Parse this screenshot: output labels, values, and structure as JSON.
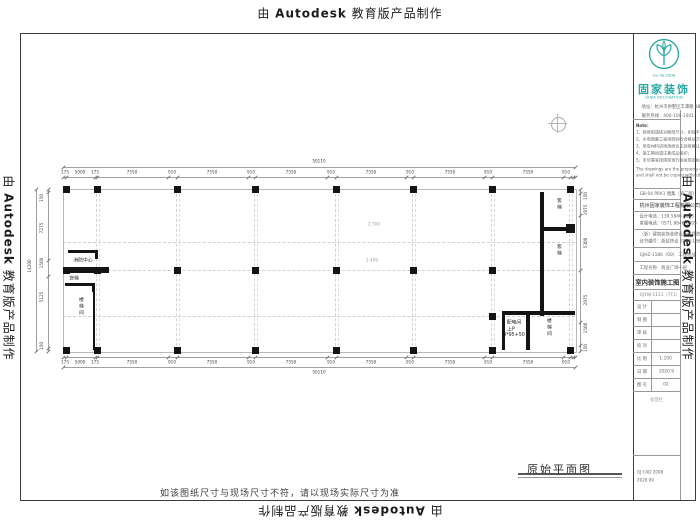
{
  "watermark": {
    "prefix": "由 ",
    "brand": "Autodesk",
    "suffix": " 教育版产品制作"
  },
  "footer_note": "如该图纸尺寸与现场尺寸不符，请以现场实际尺寸为准",
  "drawing_title": "原始平面图",
  "brand": {
    "color": "#2aa7a2",
    "badge_year": "Gu Jia 2008",
    "name_cn": "固家装饰",
    "name_en": "GUJIA DECORATION"
  },
  "titleblock": {
    "address_lines": [
      "地址：杭州市拱墅区丰潭路 88 号",
      "服务热线：400-100-1001"
    ],
    "note_title": "Note：",
    "notes": [
      "1、装修前请核对图纸尺寸，如有不符请及时联系设计师；",
      "2、水电隐蔽工程须经验收合格后方可封闭；",
      "3、所有材料进场须经业主验收确认后方可施工；",
      "4、施工期间请注意成品保护；",
      "5、未尽事宜按国家现行相关规范执行。"
    ],
    "legal_lines": [
      "The drawings are the property of GUJIA DECORATION",
      "and shall not be copied without permission."
    ],
    "spec_line": "GB-04 PRA1 图集（第二版）",
    "company": "杭州固家装饰工程有限公司",
    "phone_lines": [
      "设计电话：139 5846 6805",
      "客服电话：0571 8846 6805"
    ],
    "cert_lines": [
      "（浙）建筑装饰装修设计专项资质",
      "证书编号：浙装饰设 2008-186 号"
    ],
    "project_no_line": "GJHZ-1186（00） 工程地址",
    "project_name_line": "工程名称：商业广场一层",
    "doc_type": "室内装饰施工图",
    "doc_code": "GJYW-1111（7F1）",
    "table_rows": [
      [
        "设 计",
        ""
      ],
      [
        "制 图",
        ""
      ],
      [
        "审 核",
        ""
      ],
      [
        "校 对",
        ""
      ],
      [
        "比 例",
        "1:100"
      ],
      [
        "日 期",
        "2020.9"
      ],
      [
        "图 号",
        "02"
      ]
    ],
    "visa_label": "会签栏",
    "footer_lines": [
      "GJ·CAD 2008",
      "2020.09"
    ]
  },
  "plan": {
    "outline": [
      63,
      189,
      512,
      162
    ],
    "dash_v": [
      97,
      177,
      255,
      336,
      413,
      492,
      570
    ],
    "dash_h": [
      242,
      270,
      316
    ],
    "columns": [
      [
        66,
        189
      ],
      [
        97,
        189
      ],
      [
        177,
        189
      ],
      [
        255,
        189
      ],
      [
        336,
        189
      ],
      [
        413,
        189
      ],
      [
        492,
        189
      ],
      [
        570,
        189
      ],
      [
        66,
        270
      ],
      [
        97,
        270
      ],
      [
        177,
        270
      ],
      [
        255,
        270
      ],
      [
        336,
        270
      ],
      [
        413,
        270
      ],
      [
        492,
        270
      ],
      [
        66,
        350
      ],
      [
        97,
        350
      ],
      [
        177,
        350
      ],
      [
        255,
        350
      ],
      [
        336,
        350
      ],
      [
        413,
        350
      ],
      [
        492,
        350
      ],
      [
        570,
        350
      ],
      [
        492,
        316
      ]
    ],
    "walls": [
      [
        68,
        250,
        30,
        3
      ],
      [
        95,
        250,
        3,
        9
      ],
      [
        63,
        267,
        46,
        6
      ],
      [
        65,
        283,
        30,
        3
      ],
      [
        92,
        283,
        3,
        9
      ],
      [
        93,
        286,
        2,
        64
      ],
      [
        540,
        192,
        4,
        124
      ],
      [
        544,
        227,
        28,
        4
      ],
      [
        566,
        224,
        9,
        9
      ],
      [
        502,
        311,
        73,
        4
      ],
      [
        502,
        315,
        3,
        35
      ],
      [
        526,
        315,
        4,
        35
      ]
    ],
    "dim_lines": [
      [
        63,
        167,
        512,
        1
      ],
      [
        63,
        177,
        512,
        1
      ],
      [
        63,
        357,
        512,
        1
      ],
      [
        63,
        367,
        512,
        1
      ],
      [
        48,
        189,
        1,
        162
      ],
      [
        36,
        189,
        1,
        162
      ],
      [
        580,
        189,
        1,
        162
      ]
    ],
    "dim_labels": [
      {
        "x": 319,
        "y": 158,
        "t": "50110",
        "rot": 0
      },
      {
        "x": 65,
        "y": 169,
        "t": "175",
        "rot": 0
      },
      {
        "x": 80,
        "y": 169,
        "t": "5000",
        "rot": 0
      },
      {
        "x": 95,
        "y": 169,
        "t": "175",
        "rot": 0
      },
      {
        "x": 132,
        "y": 169,
        "t": "7550",
        "rot": 0
      },
      {
        "x": 172,
        "y": 169,
        "t": "910",
        "rot": 0
      },
      {
        "x": 212,
        "y": 169,
        "t": "7550",
        "rot": 0
      },
      {
        "x": 251,
        "y": 169,
        "t": "910",
        "rot": 0
      },
      {
        "x": 291,
        "y": 169,
        "t": "7550",
        "rot": 0
      },
      {
        "x": 331,
        "y": 169,
        "t": "910",
        "rot": 0
      },
      {
        "x": 371,
        "y": 169,
        "t": "7550",
        "rot": 0
      },
      {
        "x": 410,
        "y": 169,
        "t": "910",
        "rot": 0
      },
      {
        "x": 450,
        "y": 169,
        "t": "7550",
        "rot": 0
      },
      {
        "x": 488,
        "y": 169,
        "t": "910",
        "rot": 0
      },
      {
        "x": 528,
        "y": 169,
        "t": "7550",
        "rot": 0
      },
      {
        "x": 566,
        "y": 169,
        "t": "910",
        "rot": 0
      },
      {
        "x": 65,
        "y": 359,
        "t": "175",
        "rot": 0
      },
      {
        "x": 80,
        "y": 359,
        "t": "5000",
        "rot": 0
      },
      {
        "x": 95,
        "y": 359,
        "t": "175",
        "rot": 0
      },
      {
        "x": 132,
        "y": 359,
        "t": "7550",
        "rot": 0
      },
      {
        "x": 172,
        "y": 359,
        "t": "910",
        "rot": 0
      },
      {
        "x": 212,
        "y": 359,
        "t": "7550",
        "rot": 0
      },
      {
        "x": 251,
        "y": 359,
        "t": "910",
        "rot": 0
      },
      {
        "x": 291,
        "y": 359,
        "t": "7550",
        "rot": 0
      },
      {
        "x": 331,
        "y": 359,
        "t": "910",
        "rot": 0
      },
      {
        "x": 371,
        "y": 359,
        "t": "7550",
        "rot": 0
      },
      {
        "x": 410,
        "y": 359,
        "t": "910",
        "rot": 0
      },
      {
        "x": 450,
        "y": 359,
        "t": "7550",
        "rot": 0
      },
      {
        "x": 488,
        "y": 359,
        "t": "910",
        "rot": 0
      },
      {
        "x": 528,
        "y": 359,
        "t": "7550",
        "rot": 0
      },
      {
        "x": 566,
        "y": 359,
        "t": "910",
        "rot": 0
      },
      {
        "x": 319,
        "y": 369,
        "t": "50110",
        "rot": 0
      },
      {
        "x": 42,
        "y": 198,
        "t": "150",
        "rot": 1
      },
      {
        "x": 42,
        "y": 228,
        "t": "7275",
        "rot": 1
      },
      {
        "x": 42,
        "y": 263,
        "t": "1500",
        "rot": 1
      },
      {
        "x": 42,
        "y": 297,
        "t": "5125",
        "rot": 1
      },
      {
        "x": 42,
        "y": 346,
        "t": "150",
        "rot": 1
      },
      {
        "x": 30,
        "y": 266,
        "t": "14200",
        "rot": 1
      },
      {
        "x": 586,
        "y": 196,
        "t": "150",
        "rot": 1
      },
      {
        "x": 586,
        "y": 210,
        "t": "1975",
        "rot": 1
      },
      {
        "x": 586,
        "y": 243,
        "t": "5300",
        "rot": 1
      },
      {
        "x": 586,
        "y": 300,
        "t": "2975",
        "rot": 1
      },
      {
        "x": 586,
        "y": 328,
        "t": "1500",
        "rot": 1
      },
      {
        "x": 586,
        "y": 348,
        "t": "150",
        "rot": 1
      }
    ],
    "ticks_h": [
      {
        "y": 177,
        "xs": [
          63,
          66,
          95,
          97,
          168,
          177,
          248,
          255,
          327,
          336,
          406,
          413,
          484,
          492,
          563,
          570,
          573,
          575
        ]
      },
      {
        "y": 357,
        "xs": [
          63,
          66,
          95,
          97,
          168,
          177,
          248,
          255,
          327,
          336,
          406,
          413,
          484,
          492,
          563,
          570,
          573,
          575
        ]
      },
      {
        "y": 167,
        "xs": [
          63,
          575
        ]
      },
      {
        "y": 367,
        "xs": [
          63,
          575
        ]
      }
    ],
    "ticks_v": [
      {
        "x": 48,
        "ys": [
          189,
          192,
          260,
          276,
          348,
          351
        ]
      },
      {
        "x": 36,
        "ys": [
          189,
          351
        ]
      },
      {
        "x": 580,
        "ys": [
          189,
          193,
          215,
          270,
          322,
          345,
          351
        ]
      }
    ],
    "rooms": [
      {
        "t": "消防中心",
        "x": 83,
        "y": 256,
        "v": 0
      },
      {
        "t": "货梯",
        "x": 74,
        "y": 274,
        "v": 0
      },
      {
        "t": "楼梯间",
        "x": 77,
        "y": 297,
        "v": 1
      },
      {
        "t": "客梯",
        "x": 555,
        "y": 198,
        "v": 1
      },
      {
        "t": "客梯",
        "x": 555,
        "y": 244,
        "v": 1
      },
      {
        "t": "配电间",
        "x": 514,
        "y": 318,
        "v": 0
      },
      {
        "t": "上P",
        "x": 511,
        "y": 325,
        "v": 0
      },
      {
        "t": "4*95+50",
        "x": 514,
        "y": 332,
        "v": 0
      },
      {
        "t": "楼梯间",
        "x": 545,
        "y": 318,
        "v": 1
      }
    ],
    "annotations": [
      {
        "t": "2.700",
        "x": 368,
        "y": 222
      },
      {
        "t": "2.400",
        "x": 366,
        "y": 258
      }
    ]
  }
}
